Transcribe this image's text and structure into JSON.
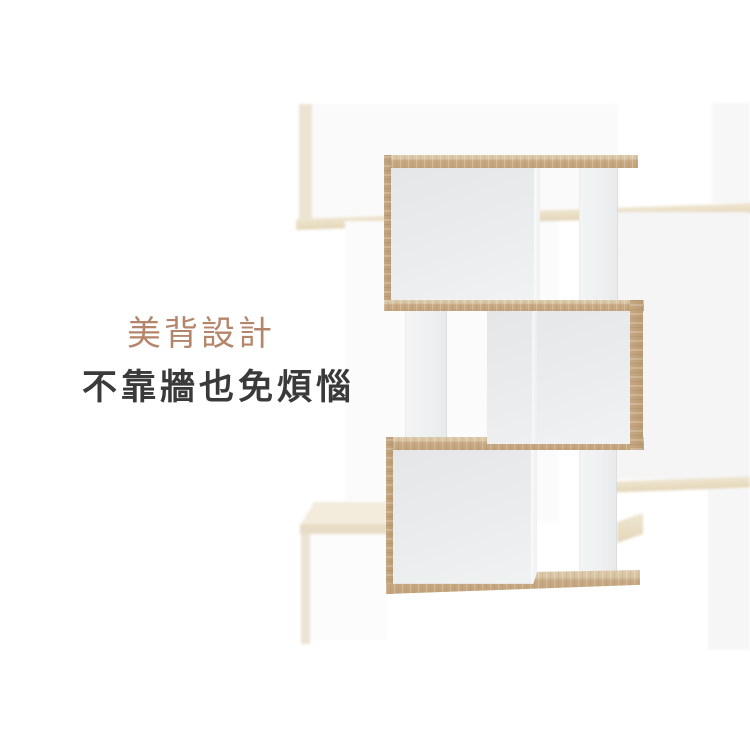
{
  "caption": {
    "title": "美背設計",
    "subtitle": "不靠牆也免煩惱",
    "title_color": "#b4856a",
    "subtitle_color": "#3a3a3a"
  },
  "palette": {
    "wood": "#c8ab85",
    "wood_top_face": "#decbab",
    "wood_side_edge": "#b99b75",
    "panel_gray_white": "#eaecee",
    "column_white": "#eff1f2",
    "background_wood_faint": "#e8dcc2",
    "background_panel_faint": "#f5f5f6",
    "page_background": "#ffffff"
  }
}
